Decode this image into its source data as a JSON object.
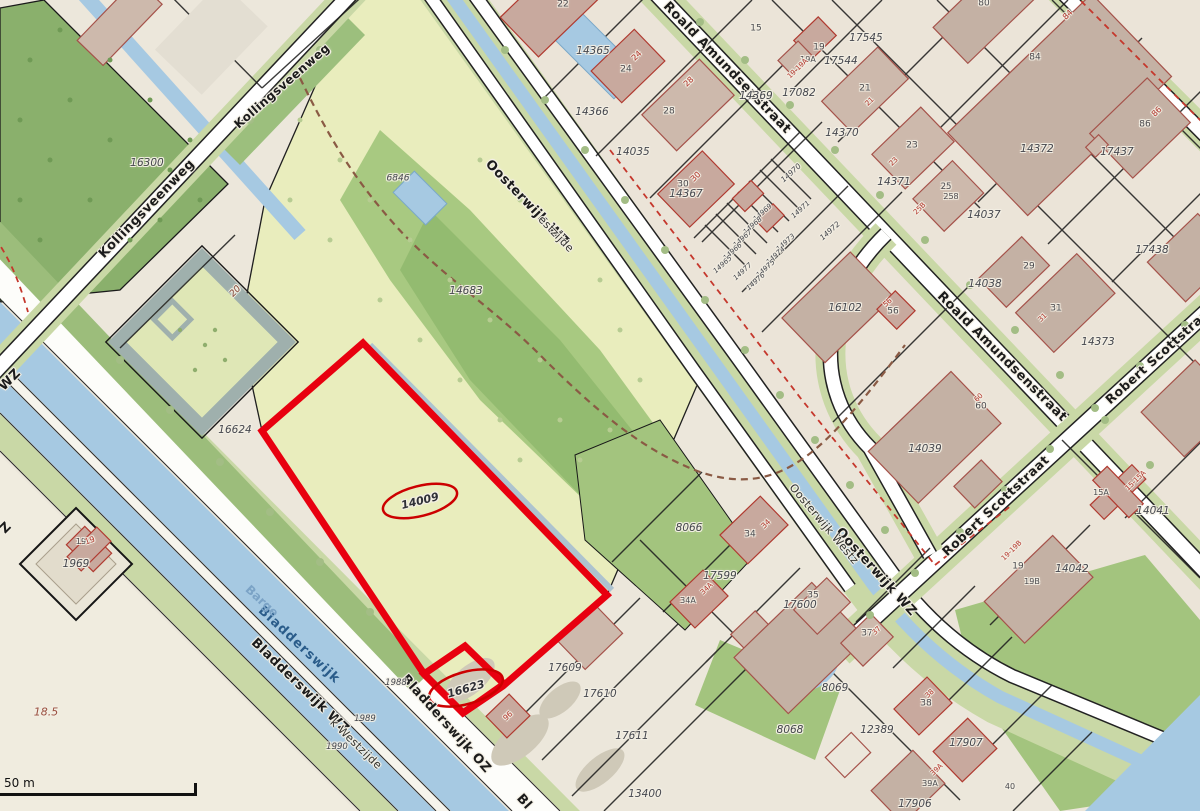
{
  "map": {
    "kind": "cadastral-parcel-map",
    "scale_bar": {
      "label": "50 m"
    },
    "highlighted_parcels": [
      "14009",
      "16623"
    ],
    "colors": {
      "highlight_red": "#e8000f",
      "ellipse_red": "#cc0000",
      "water": "#a6c9e2",
      "field_green": "#e9edbd",
      "forest_green": "#8ab06c",
      "verge_green": "#c9d8a6",
      "road_white": "#ffffff",
      "building_tan": "#cdb9ac",
      "building_outline": "#a5524a",
      "dashed_red": "#c5372c",
      "parcel_text": "#45474e",
      "street_text": "#1b1b1b",
      "water_text": "#2a5c8a"
    },
    "label_groups": [
      {
        "name": "street-label",
        "cls": "lbl-street",
        "items": [
          {
            "t": "Kollingsveenweg",
            "x": 147,
            "y": 209,
            "r": -46
          },
          {
            "t": "Kollingsveenweg",
            "x": 282,
            "y": 86,
            "r": -41,
            "s": 12
          },
          {
            "t": "Oosterwijk WZ",
            "x": 527,
            "y": 203,
            "r": 46
          },
          {
            "t": "Roald Amundsenstraat",
            "x": 727,
            "y": 68,
            "r": 46
          },
          {
            "t": "Roald Amundsenstraat",
            "x": 1002,
            "y": 357,
            "r": 45
          },
          {
            "t": "Robert Scottstraat",
            "x": 1160,
            "y": 355,
            "r": -42,
            "s": 12.5
          },
          {
            "t": "Robert Scottstraat",
            "x": 996,
            "y": 506,
            "r": -43,
            "s": 12.5
          },
          {
            "t": "Oosterwijk WZ",
            "x": 876,
            "y": 572,
            "r": 48
          },
          {
            "t": "Bladderswijk WZ",
            "x": 300,
            "y": 686,
            "r": 44
          },
          {
            "t": "Bladderswijk OZ",
            "x": 446,
            "y": 724,
            "r": 48
          },
          {
            "t": "WZ",
            "x": 10,
            "y": 380,
            "r": -45
          },
          {
            "t": "Z",
            "x": 6,
            "y": 528,
            "r": -45
          },
          {
            "t": "Bl",
            "x": 524,
            "y": 802,
            "r": 48
          }
        ]
      },
      {
        "name": "street-label-secondary",
        "cls": "lbl-street-thin",
        "items": [
          {
            "t": "estzijde",
            "x": 556,
            "y": 234,
            "r": 46
          },
          {
            "t": "Oosterwijk Westz",
            "x": 824,
            "y": 524,
            "r": 50
          },
          {
            "t": "k Westzijde",
            "x": 356,
            "y": 744,
            "r": 44
          }
        ]
      },
      {
        "name": "water-label",
        "cls": "lbl-water",
        "items": [
          {
            "t": "Bladderswijk",
            "x": 299,
            "y": 645,
            "r": 43
          }
        ]
      },
      {
        "name": "water-label-secondary",
        "cls": "lbl-water-light",
        "items": [
          {
            "t": "Barge",
            "x": 262,
            "y": 601,
            "r": 43
          }
        ]
      },
      {
        "name": "parcel-number",
        "cls": "lbl-parcel",
        "items": [
          {
            "t": "16300",
            "x": 147,
            "y": 163
          },
          {
            "t": "6846",
            "x": 398,
            "y": 179,
            "s": 9
          },
          {
            "t": "14365",
            "x": 593,
            "y": 51
          },
          {
            "t": "14366",
            "x": 592,
            "y": 112
          },
          {
            "t": "14035",
            "x": 633,
            "y": 152
          },
          {
            "t": "14367",
            "x": 686,
            "y": 194
          },
          {
            "t": "14369",
            "x": 756,
            "y": 96
          },
          {
            "t": "14370",
            "x": 842,
            "y": 133
          },
          {
            "t": "14371",
            "x": 894,
            "y": 182
          },
          {
            "t": "14372",
            "x": 1037,
            "y": 149
          },
          {
            "t": "17545",
            "x": 866,
            "y": 38
          },
          {
            "t": "17544",
            "x": 841,
            "y": 61
          },
          {
            "t": "17082",
            "x": 799,
            "y": 93
          },
          {
            "t": "14037",
            "x": 984,
            "y": 215
          },
          {
            "t": "17437",
            "x": 1117,
            "y": 152
          },
          {
            "t": "17438",
            "x": 1152,
            "y": 250
          },
          {
            "t": "14038",
            "x": 985,
            "y": 284
          },
          {
            "t": "16102",
            "x": 845,
            "y": 308
          },
          {
            "t": "14373",
            "x": 1098,
            "y": 342
          },
          {
            "t": "14039",
            "x": 925,
            "y": 449
          },
          {
            "t": "14041",
            "x": 1153,
            "y": 511
          },
          {
            "t": "14042",
            "x": 1072,
            "y": 569
          },
          {
            "t": "14683",
            "x": 466,
            "y": 291
          },
          {
            "t": "16624",
            "x": 235,
            "y": 430
          },
          {
            "t": "8066",
            "x": 689,
            "y": 528
          },
          {
            "t": "17599",
            "x": 720,
            "y": 576
          },
          {
            "t": "17600",
            "x": 800,
            "y": 605
          },
          {
            "t": "17609",
            "x": 565,
            "y": 668
          },
          {
            "t": "17610",
            "x": 600,
            "y": 694
          },
          {
            "t": "17611",
            "x": 632,
            "y": 736
          },
          {
            "t": "13400",
            "x": 645,
            "y": 794
          },
          {
            "t": "8069",
            "x": 835,
            "y": 688
          },
          {
            "t": "8068",
            "x": 790,
            "y": 730
          },
          {
            "t": "12389",
            "x": 877,
            "y": 730
          },
          {
            "t": "17907",
            "x": 966,
            "y": 743
          },
          {
            "t": "17906",
            "x": 915,
            "y": 804
          },
          {
            "t": "1969",
            "x": 76,
            "y": 564
          },
          {
            "t": "1988",
            "x": 396,
            "y": 683,
            "s": 8.5
          },
          {
            "t": "1989",
            "x": 365,
            "y": 719,
            "s": 8.5
          },
          {
            "t": "1990",
            "x": 337,
            "y": 747,
            "s": 8.5
          },
          {
            "t": "14970",
            "x": 791,
            "y": 173,
            "r": -42,
            "s": 7.5
          },
          {
            "t": "14971",
            "x": 801,
            "y": 210,
            "r": -42,
            "s": 7
          },
          {
            "t": "14969",
            "x": 763,
            "y": 213,
            "r": -42,
            "s": 7
          },
          {
            "t": "14968",
            "x": 753,
            "y": 226,
            "r": -42,
            "s": 7
          },
          {
            "t": "14967",
            "x": 743,
            "y": 239,
            "r": -42,
            "s": 7
          },
          {
            "t": "14966",
            "x": 733,
            "y": 252,
            "r": -42,
            "s": 7
          },
          {
            "t": "14965",
            "x": 723,
            "y": 265,
            "r": -42,
            "s": 7
          },
          {
            "t": "14972",
            "x": 830,
            "y": 231,
            "r": -42,
            "s": 7.5
          },
          {
            "t": "14973",
            "x": 786,
            "y": 243,
            "r": -42,
            "s": 7
          },
          {
            "t": "14974",
            "x": 776,
            "y": 256,
            "r": -42,
            "s": 7
          },
          {
            "t": "14975",
            "x": 766,
            "y": 269,
            "r": -42,
            "s": 7
          },
          {
            "t": "14976",
            "x": 756,
            "y": 282,
            "r": -42,
            "s": 7
          },
          {
            "t": "14977",
            "x": 743,
            "y": 272,
            "r": -42,
            "s": 7
          }
        ]
      },
      {
        "name": "highlight-parcel-number",
        "cls": "lbl-high",
        "items": [
          {
            "t": "14009",
            "x": 420,
            "y": 501,
            "r": -14
          },
          {
            "t": "16623",
            "x": 466,
            "y": 689,
            "r": -16
          }
        ]
      },
      {
        "name": "house-number",
        "cls": "lbl-bnum",
        "items": [
          {
            "t": "22",
            "x": 563,
            "y": 5
          },
          {
            "t": "24",
            "x": 626,
            "y": 70
          },
          {
            "t": "28",
            "x": 669,
            "y": 112
          },
          {
            "t": "30",
            "x": 683,
            "y": 185
          },
          {
            "t": "15",
            "x": 756,
            "y": 29
          },
          {
            "t": "19",
            "x": 819,
            "y": 48
          },
          {
            "t": "19A",
            "x": 808,
            "y": 60,
            "s": 8
          },
          {
            "t": "21",
            "x": 865,
            "y": 89
          },
          {
            "t": "23",
            "x": 912,
            "y": 146
          },
          {
            "t": "25",
            "x": 946,
            "y": 187,
            "s": 8.5
          },
          {
            "t": "258",
            "x": 951,
            "y": 197,
            "s": 8
          },
          {
            "t": "29",
            "x": 1029,
            "y": 267
          },
          {
            "t": "31",
            "x": 1056,
            "y": 309
          },
          {
            "t": "84",
            "x": 1035,
            "y": 58
          },
          {
            "t": "86",
            "x": 1145,
            "y": 125
          },
          {
            "t": "80",
            "x": 984,
            "y": 4
          },
          {
            "t": "60",
            "x": 981,
            "y": 407
          },
          {
            "t": "56",
            "x": 893,
            "y": 312
          },
          {
            "t": "34",
            "x": 750,
            "y": 535
          },
          {
            "t": "34A",
            "x": 688,
            "y": 601,
            "s": 8
          },
          {
            "t": "15A",
            "x": 1101,
            "y": 493,
            "s": 8
          },
          {
            "t": "19",
            "x": 1018,
            "y": 567
          },
          {
            "t": "19B",
            "x": 1032,
            "y": 582,
            "s": 8
          },
          {
            "t": "37",
            "x": 867,
            "y": 634
          },
          {
            "t": "38",
            "x": 926,
            "y": 704
          },
          {
            "t": "39A",
            "x": 930,
            "y": 784,
            "s": 8
          },
          {
            "t": "35",
            "x": 813,
            "y": 596
          },
          {
            "t": "40",
            "x": 1010,
            "y": 787,
            "s": 8
          },
          {
            "t": "19",
            "x": 81,
            "y": 542,
            "s": 8
          }
        ]
      },
      {
        "name": "house-number-red",
        "cls": "lbl-bnum-red",
        "items": [
          {
            "t": "24",
            "x": 637,
            "y": 56,
            "r": -44
          },
          {
            "t": "28",
            "x": 689,
            "y": 82,
            "r": -44
          },
          {
            "t": "30",
            "x": 696,
            "y": 177,
            "r": -44
          },
          {
            "t": "84",
            "x": 1068,
            "y": 15,
            "r": -44
          },
          {
            "t": "86",
            "x": 1157,
            "y": 112,
            "r": -44
          },
          {
            "t": "19-19A",
            "x": 798,
            "y": 69,
            "r": -44,
            "s": 7
          },
          {
            "t": "21",
            "x": 870,
            "y": 102,
            "r": -44,
            "s": 7
          },
          {
            "t": "23",
            "x": 894,
            "y": 162,
            "r": -44,
            "s": 7
          },
          {
            "t": "25B",
            "x": 920,
            "y": 209,
            "r": -44,
            "s": 7
          },
          {
            "t": "31",
            "x": 1043,
            "y": 318,
            "r": -44,
            "s": 7
          },
          {
            "t": "56",
            "x": 888,
            "y": 303,
            "r": -44,
            "s": 7
          },
          {
            "t": "60",
            "x": 979,
            "y": 398,
            "r": -44,
            "s": 7
          },
          {
            "t": "34",
            "x": 766,
            "y": 524,
            "r": -44,
            "s": 7.5
          },
          {
            "t": "34A",
            "x": 707,
            "y": 589,
            "r": -44,
            "s": 7
          },
          {
            "t": "15-15A",
            "x": 1136,
            "y": 481,
            "r": -44,
            "s": 7
          },
          {
            "t": "19-19B",
            "x": 1012,
            "y": 551,
            "r": -44,
            "s": 7
          },
          {
            "t": "37",
            "x": 877,
            "y": 631,
            "r": -44,
            "s": 7
          },
          {
            "t": "38",
            "x": 930,
            "y": 694,
            "r": -44,
            "s": 7
          },
          {
            "t": "39A",
            "x": 937,
            "y": 770,
            "r": -44,
            "s": 7
          },
          {
            "t": "96",
            "x": 508,
            "y": 716,
            "r": -44,
            "s": 7.5
          },
          {
            "t": "19",
            "x": 90,
            "y": 541,
            "r": -20,
            "s": 8
          }
        ]
      },
      {
        "name": "annotation",
        "cls": "lbl-misc",
        "items": [
          {
            "t": "18.5",
            "x": 46,
            "y": 712
          },
          {
            "t": "20",
            "x": 236,
            "y": 292,
            "r": -45,
            "s": 9,
            "c": "#8a4a3a"
          }
        ]
      }
    ]
  }
}
